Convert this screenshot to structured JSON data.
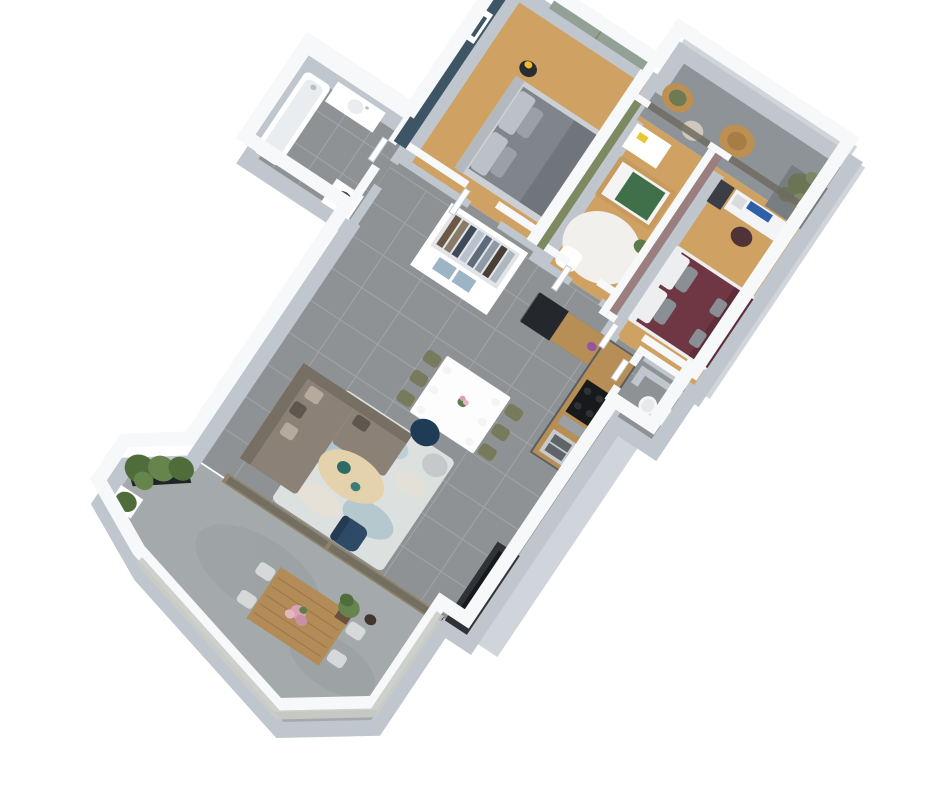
{
  "scene": {
    "kind": "isometric-3d-floor-plan-render",
    "background": "#ffffff"
  },
  "rooms": [
    {
      "name": "master-bedroom",
      "floor": "wood",
      "features": [
        "double-bed-gray",
        "mirror-sliding-wardrobe",
        "black-bedside-table",
        "yellow-table-lamp",
        "picture-frame",
        "blue-accent-wall"
      ]
    },
    {
      "name": "bathroom",
      "floor": "gray-tile",
      "features": [
        "bathtub",
        "shower-fixture",
        "vanity-sink",
        "washing-machine"
      ]
    },
    {
      "name": "nursery",
      "floor": "wood",
      "features": [
        "crib-green-bedding",
        "dresser",
        "round-white-rug",
        "rocking-chair",
        "green-dino-toy",
        "yellow-stool",
        "green-accent-wall"
      ]
    },
    {
      "name": "bedroom-2",
      "floor": "wood",
      "features": [
        "double-bed-burgundy",
        "white-desk",
        "monitor",
        "office-chair",
        "drawer-unit",
        "mauve-accent-wall"
      ]
    },
    {
      "name": "balcony",
      "floor": "concrete",
      "features": [
        "rattan-chair",
        "rattan-peacock-chair",
        "side-pouf",
        "olive-tree-planter",
        "privacy-screen",
        "glass-railing"
      ]
    },
    {
      "name": "hallway",
      "floor": "gray-tile",
      "features": [
        "open-wardrobe-with-clothes",
        "blue-storage-boxes"
      ]
    },
    {
      "name": "kitchen",
      "floor": "gray-tile",
      "features": [
        "black-fridge",
        "wood-countertop",
        "cooktop",
        "oven",
        "double-sink",
        "purple-flowers"
      ]
    },
    {
      "name": "wc",
      "floor": "gray-tile",
      "features": [
        "toilet"
      ]
    },
    {
      "name": "living-dining",
      "floor": "gray-tile",
      "features": [
        "white-dining-table",
        "six-olive-chairs",
        "sectional-sofa",
        "blue-cream-rug",
        "oval-coffee-table",
        "navy-pouf",
        "gray-pouf",
        "navy-armchair",
        "tv",
        "media-unit",
        "glass-doors-to-terrace"
      ]
    },
    {
      "name": "terrace",
      "floor": "concrete",
      "features": [
        "black-planter-hedge",
        "small-white-planter",
        "wood-outdoor-table",
        "four-outdoor-chairs",
        "pink-bouquet",
        "potted-plant",
        "dark-vase",
        "glass-railing"
      ]
    }
  ],
  "colors": {
    "background": "#ffffff",
    "wallTop": "#f6f8fa",
    "wallSide": "#bfc6cd",
    "wallFace": "#cfd5da",
    "tile": "#8e9295",
    "grout": "#a6aaad",
    "wood": "#cfa263",
    "terraceFloor": "#a4a9ab",
    "terraceStain": "#969c9e",
    "balconyFloor": "#8d9396",
    "accentBlue": "#3d5565",
    "accentGreen": "#7c8a62",
    "accentMauve": "#9a7e80",
    "mirror": "#93a096",
    "glassDark": "#6f6b62",
    "glassLight": "#c9ccc6",
    "frameWood": "#8f8266",
    "railScreen": "#554f3f",
    "bedFrame": "#ccd0d5",
    "headboard": "#b4b9bf",
    "duvet": "#80858c",
    "duvetDark": "#70757c",
    "pillowLight": "#bcc1c7",
    "pillowMid": "#9aa0a7",
    "black": "#2a2d30",
    "lampYellow": "#f2b92d",
    "white": "#ffffff",
    "tubInner": "#e9edef",
    "fixture": "#b9bec3",
    "washerDoor": "#3a3e43",
    "washerDoorInner": "#6b7077",
    "rugWhite": "#f1f0ed",
    "cribWood": "#c89a5e",
    "cribMattress": "#f4f4f2",
    "cribGreen": "#3f7049",
    "toyGreen": "#5d7a4a",
    "toyYellow": "#e8c832",
    "burgundy": "#6e3743",
    "burgundyDark": "#5d2e39",
    "pillowWhite": "#eceef0",
    "pillowGray": "#8a8f96",
    "deskWhite": "#f2f4f5",
    "monitor": "#2f5fa8",
    "deskChair": "#4f3336",
    "drawers": "#3b3e44",
    "printer": "#d9dbdd",
    "rattan": "#bc8f52",
    "rattanDark": "#a87c45",
    "cushionGreen": "#6d7a52",
    "poufOutdoor": "#cfc9bd",
    "planterGray": "#777d80",
    "olive": "#6b7555",
    "oliveLight": "#7c8765",
    "trunk": "#6b5334",
    "closetInner": "#e2e5e8",
    "boxBlue": "#9db4c4",
    "clothes": [
      "#6b5846",
      "#8a7a68",
      "#3f4a58",
      "#b9c2cc",
      "#5d6b7a",
      "#8f9aa6",
      "#4a3f36",
      "#aeb6bf"
    ],
    "cabinet": "#595e63",
    "counterWood": "#b78e55",
    "fridge": "#24272b",
    "cooktop": "#17191b",
    "burner": "#2e3236",
    "steel": "#9aa0a5",
    "sinkSteel": "#c7cbce",
    "basin": "#5f6468",
    "toiletWhite": "#f4f5f6",
    "toiletSeat": "#e6e9eb",
    "oliveChair": "#787b5b",
    "tableWhite": "#fdfdfd",
    "tableEdge": "#e3e6e9",
    "plateWhite": "#f3f4f5",
    "flowerPink": "#d9a2b4",
    "flowerPinkDark": "#c98fa4",
    "flowerPinkLight": "#e4b7c4",
    "flowerPurple": "#9355a0",
    "leafGreen": "#5e7d4a",
    "sofa": "#8b8177",
    "sofaBack": "#776e64",
    "sofaPillowL": "#b5aa9c",
    "sofaPillowD": "#5f574e",
    "rugBase": "#dce1e0",
    "rugBlue": "#85aab8",
    "rugBlueLight": "#a9c3cc",
    "rugCream": "#e8e1d1",
    "coffeeWood": "#e4d2ac",
    "coffeeEdge": "#cdb98e",
    "teal": "#2f6b66",
    "tealLight": "#3b7d76",
    "poufNavy": "#1f3c56",
    "poufGray": "#c6c9cc",
    "armchairNavy": "#2e4a66",
    "armchairDark": "#243b52",
    "tvBlack": "#17191c",
    "tvUnit": "#2f3337",
    "bushGreen": "#4e6d3a",
    "bushLight": "#66854c",
    "planterBlack": "#212427",
    "outdoorWood": "#b28b57",
    "outdoorWoodDark": "#9a784a",
    "chairOutdoor": "#d6d8d9",
    "vaseDark": "#43362c",
    "potBrown": "#6b4f3f"
  }
}
